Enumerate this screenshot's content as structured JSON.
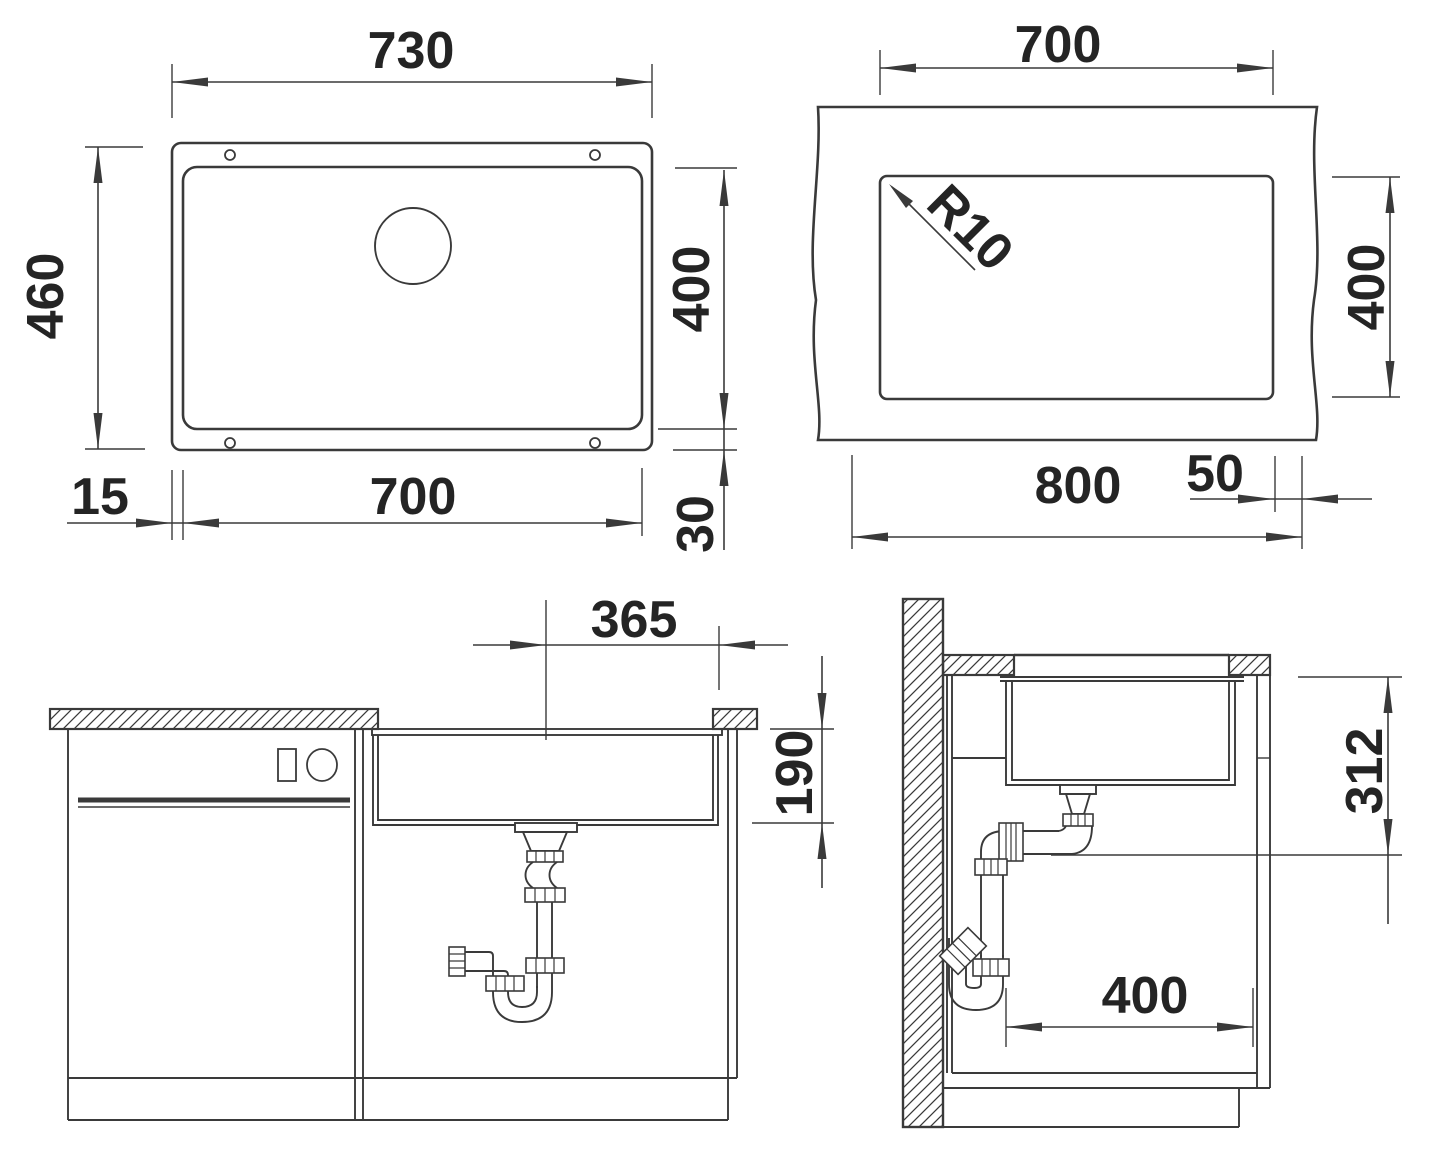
{
  "drawing": {
    "line_color": "#3a3a3a",
    "text_color": "#242424",
    "background": "#ffffff"
  },
  "views": {
    "top_view": {
      "dims": {
        "outer_width": "730",
        "outer_depth": "460",
        "inner_width": "700",
        "inner_depth": "400",
        "left_offset": "15",
        "bottom_offset": "30"
      }
    },
    "cutout_view": {
      "dims": {
        "cutout_width": "700",
        "cutout_depth": "400",
        "corner_radius": "R10",
        "side_clearance": "50",
        "cabinet_width": "800"
      }
    },
    "front_view": {
      "dims": {
        "drain_center_offset": "365",
        "bowl_depth": "190"
      }
    },
    "side_view": {
      "dims": {
        "mounting_depth": "312",
        "clearance_width": "400"
      }
    }
  }
}
